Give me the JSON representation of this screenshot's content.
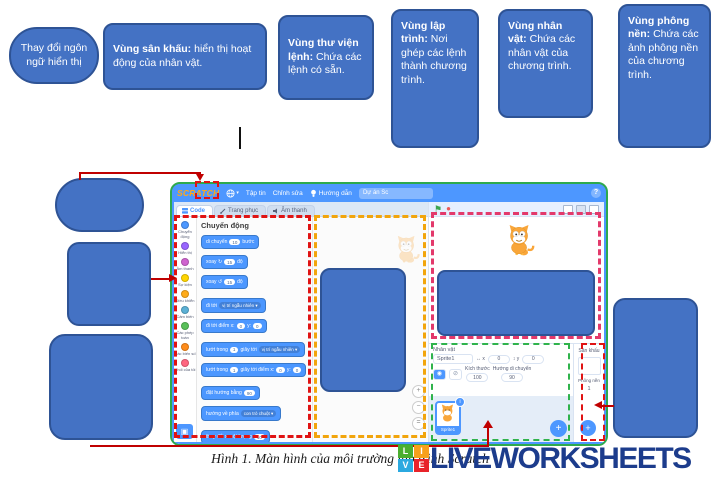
{
  "colors": {
    "callout_fill": "#4472C4",
    "callout_border": "#2E5395",
    "connector_red": "#C00000",
    "outline_red": "#E01313",
    "outline_yellow": "#F2A50C",
    "outline_pink": "#E3396B",
    "outline_green": "#2FB34C",
    "window_border_green": "#2EA94E",
    "scratch_blue": "#4D97FF",
    "watermark_navy": "#1C3C8C"
  },
  "callouts": {
    "language": {
      "text": "Thay đổi ngôn ngữ hiển thị"
    },
    "stage": {
      "bold": "Vùng sân khấu:",
      "rest": " hiển thị hoạt động của nhân vật."
    },
    "library": {
      "bold": "Vùng thư viện lệnh:",
      "rest": " Chứa các lệnh có sẵn."
    },
    "code": {
      "bold": "Vùng lập trình:",
      "rest": " Nơi ghép các lệnh thành chương trình."
    },
    "sprite": {
      "bold": "Vùng nhân vật:",
      "rest": " Chứa các nhân vật của chương trình."
    },
    "backdrop": {
      "bold": "Vùng phông nền:",
      "rest": " Chứa các ảnh phông nền của chương trình."
    }
  },
  "scratch": {
    "menubar": {
      "logo": "SCRATCH",
      "file": "Tập tin",
      "edit": "Chỉnh sửa",
      "tutorials": "Hướng dẫn",
      "project_name": "Dự án Sc",
      "help": "?"
    },
    "tabs": {
      "code": "Code",
      "costumes": "Trang phục",
      "sounds": "Âm thanh"
    },
    "palette": {
      "header": "Chuyển động",
      "categories": [
        {
          "label": "Chuyển động",
          "color": "#4C97FF"
        },
        {
          "label": "Hiển thị",
          "color": "#9966FF"
        },
        {
          "label": "Âm thanh",
          "color": "#CF63CF"
        },
        {
          "label": "Sự kiện",
          "color": "#FFD500"
        },
        {
          "label": "Điều khiển",
          "color": "#FFAB19"
        },
        {
          "label": "Cảm biến",
          "color": "#5CB1D6"
        },
        {
          "label": "Các phép toán",
          "color": "#59C059"
        },
        {
          "label": "Các biến số",
          "color": "#FF8C1A"
        },
        {
          "label": "Khối của tôi",
          "color": "#FF6680"
        }
      ],
      "blocks": [
        {
          "t1": "di chuyển",
          "v1": "10",
          "t2": "bước"
        },
        {
          "t1": "xoay ↻",
          "v1": "15",
          "t2": "độ"
        },
        {
          "t1": "xoay ↺",
          "v1": "15",
          "t2": "độ"
        },
        {
          "t1": "đi tới",
          "d1": "vị trí ngẫu nhiên ▾"
        },
        {
          "t1": "đi tới điểm x:",
          "v1": "0",
          "t2": "y:",
          "v2": "0"
        },
        {
          "t1": "lướt trong",
          "v1": "1",
          "t2": "giây tới",
          "d1": "vị trí ngẫu nhiên ▾"
        },
        {
          "t1": "lướt trong",
          "v1": "1",
          "t2": "giây tới điểm x:",
          "v2": "0",
          "t3": "y:",
          "v3": "0"
        },
        {
          "t1": "đặt hướng bằng",
          "v1": "90"
        },
        {
          "t1": "hướng về phía",
          "d1": "con trỏ chuột ▾"
        },
        {
          "t1": "thay đổi x một lượng",
          "v1": "10"
        }
      ]
    },
    "sprite_panel": {
      "title": "Nhân vật",
      "name": "Sprite1",
      "x_label": "↔ x",
      "x": "0",
      "y_label": "↕ y",
      "y": "0",
      "size_label": "Kích thước",
      "size": "100",
      "direction_label": "Hướng di chuyển",
      "direction": "90",
      "thumb_name": "Sprite1",
      "info_badge": "i"
    },
    "stage_panel": {
      "title": "Sân khấu",
      "backdrop_label": "Phông nền",
      "count": "1"
    }
  },
  "caption": "Hình 1. Màn hình của môi trường lập trình Scratch",
  "watermark": {
    "l1": "L",
    "l2": "I",
    "l3": "V",
    "l4": "E",
    "text": "LIVEWORKSHEETS"
  }
}
